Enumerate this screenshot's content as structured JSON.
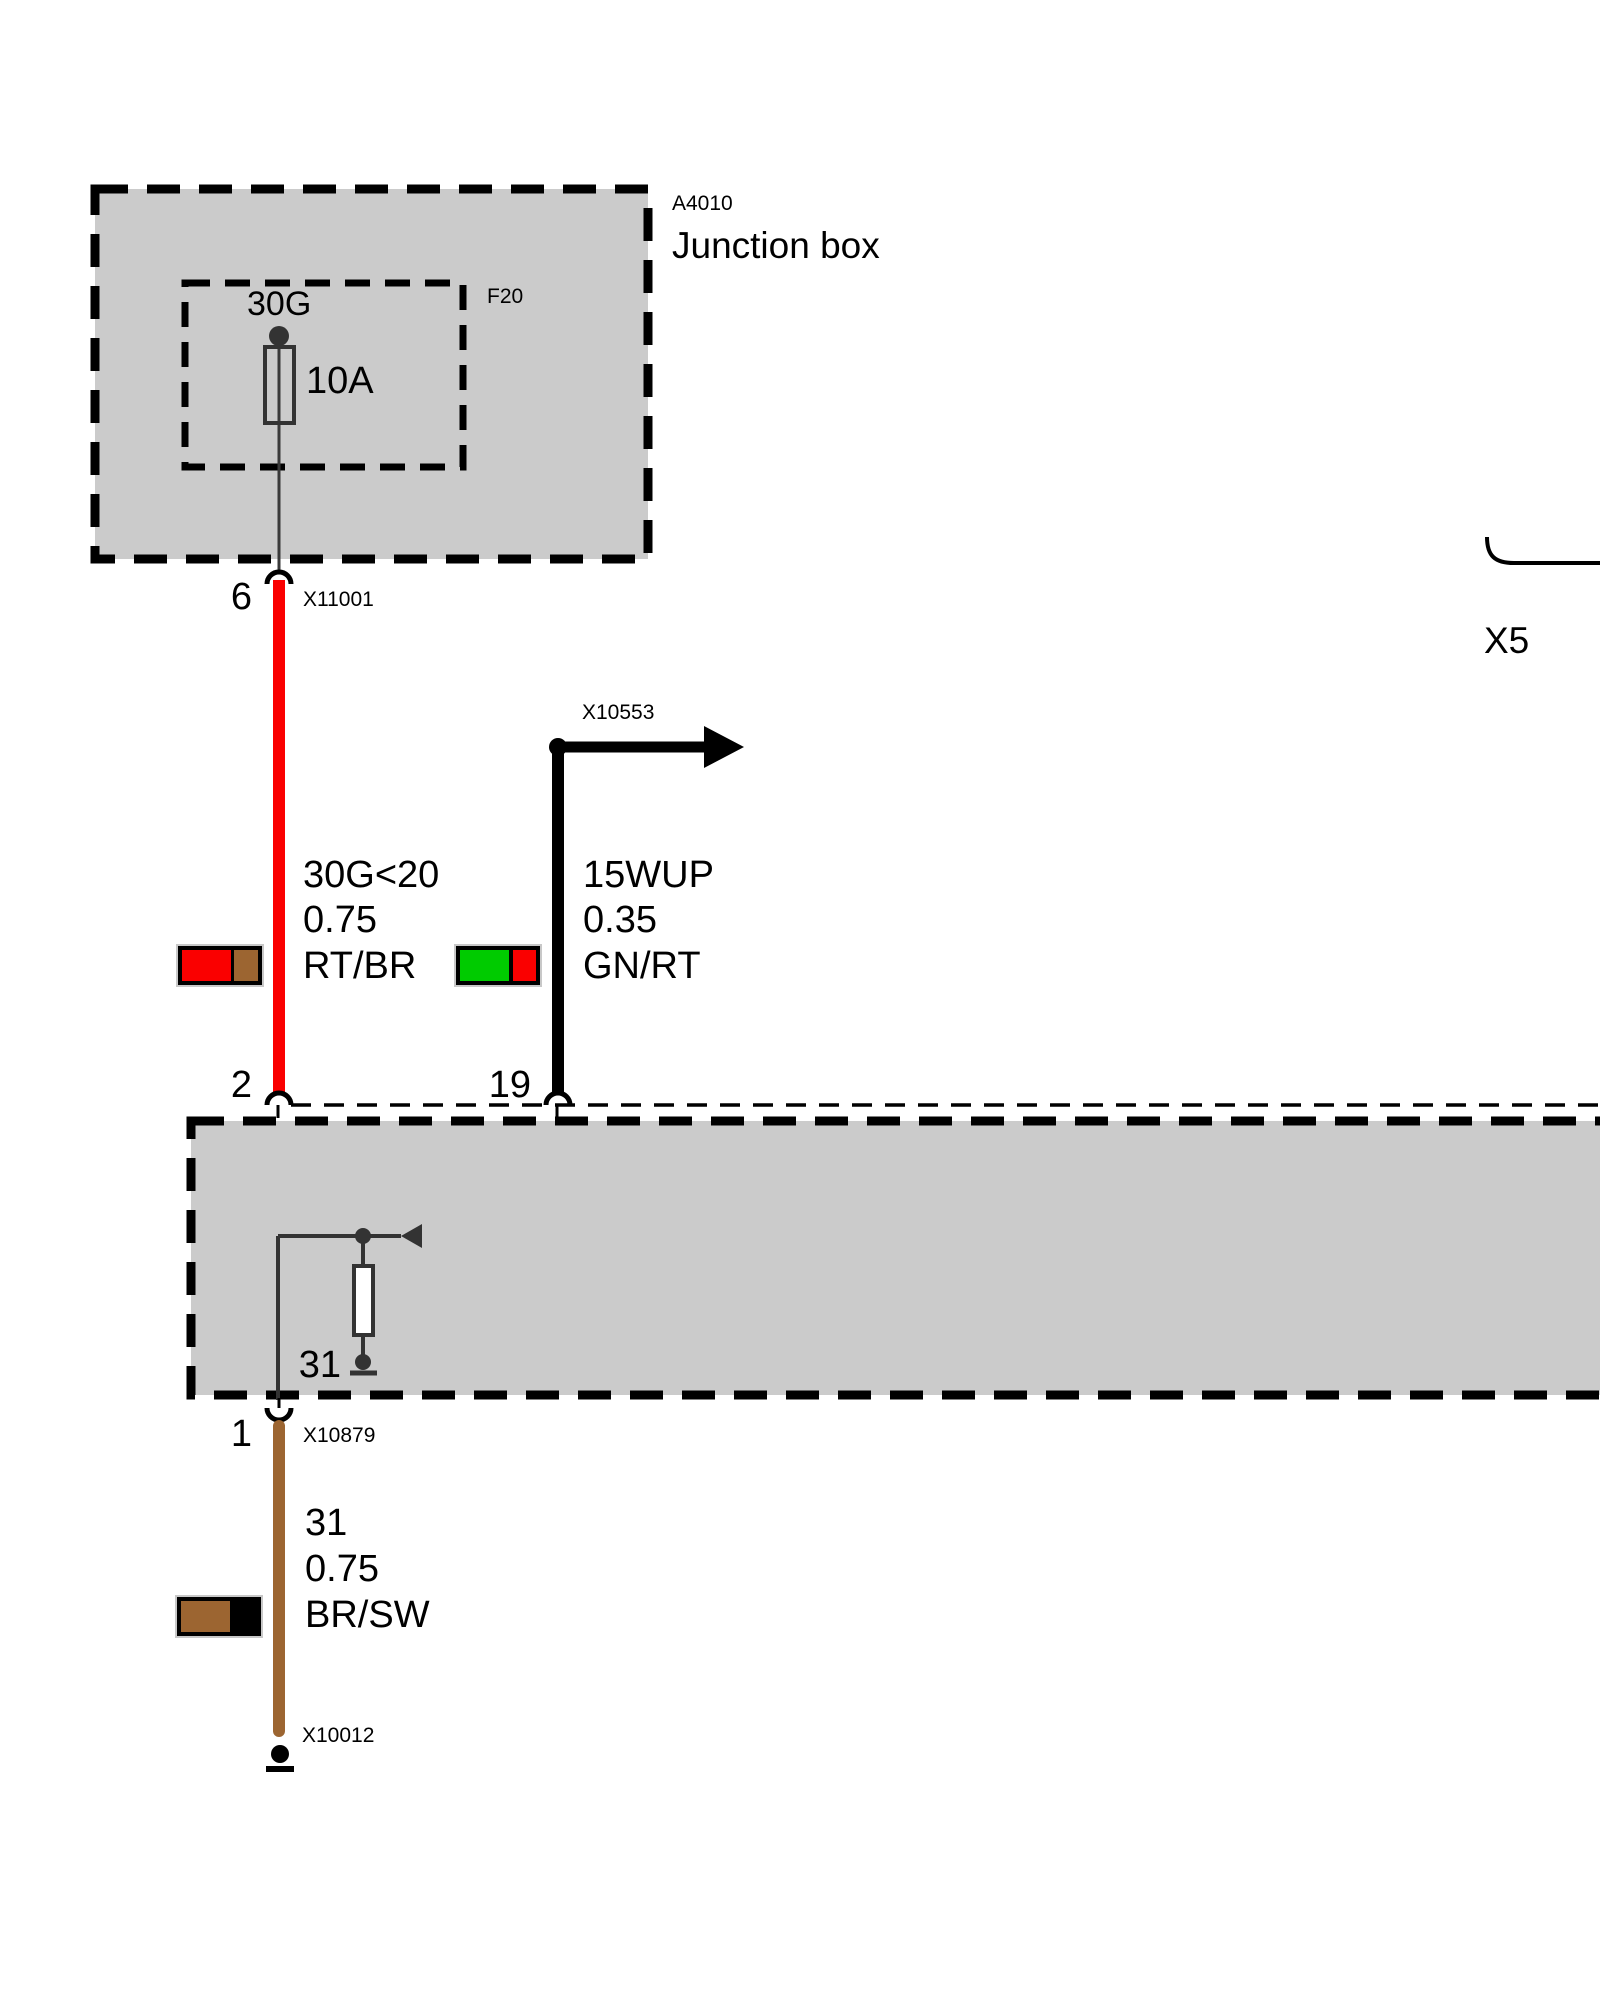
{
  "junction_box": {
    "id": "A4010",
    "name": "Junction box",
    "fuse": {
      "id": "F20",
      "circuit": "30G",
      "rating": "10A"
    }
  },
  "connectors": {
    "x11001": {
      "id": "X11001",
      "pin": "6"
    },
    "x10553": {
      "id": "X10553"
    },
    "x10879": {
      "id": "X10879",
      "pin": "1"
    },
    "x10012": {
      "id": "X10012"
    },
    "x5": {
      "id": "X5"
    },
    "module_pin_power": "2",
    "module_pin_signal": "19"
  },
  "wires": {
    "power": {
      "circuit": "30G<20",
      "size": "0.75",
      "color_code": "RT/BR"
    },
    "signal": {
      "circuit": "15WUP",
      "size": "0.35",
      "color_code": "GN/RT"
    },
    "ground": {
      "circuit": "31",
      "size": "0.75",
      "color_code": "BR/SW"
    }
  },
  "module": {
    "internal_ground_label": "31"
  },
  "colors": {
    "red": "#fa0000",
    "green": "#00cb00",
    "brown": "#9c6531",
    "black": "#000000",
    "box_fill": "#cbcbcb"
  }
}
